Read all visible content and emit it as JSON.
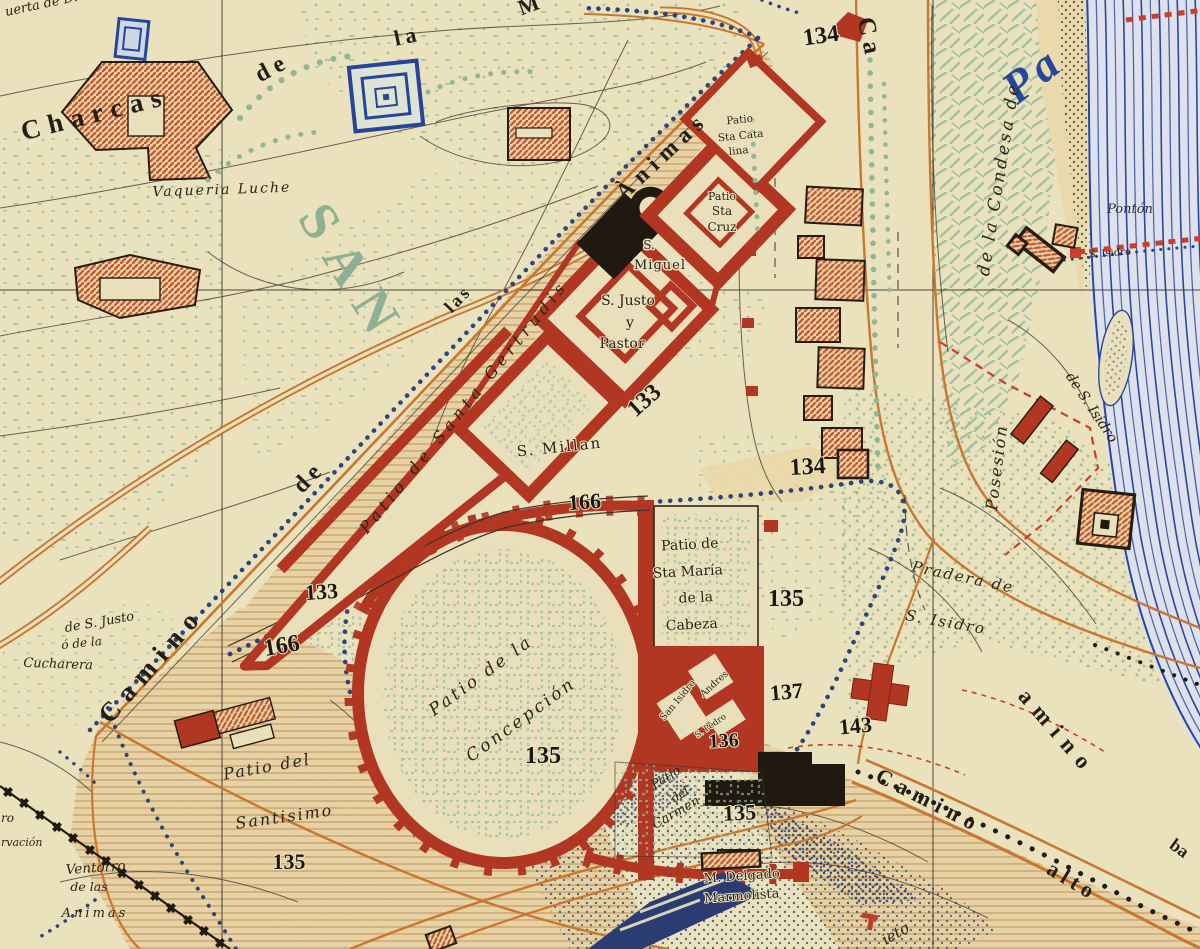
{
  "map": {
    "colors": {
      "paper": "#eae1bd",
      "wall_red": "#b23722",
      "road_orange": "#c9772f",
      "river_blue": "#2a479e",
      "dot_path_blue": "#1e3878",
      "rail_black": "#201a12",
      "stipple_green": "#9dbf9f",
      "park_green": "#9dbfa0",
      "tan_slope": "#e5d2a4",
      "dark_stipple": "#55617f",
      "building_hatch": "#bc5a31",
      "red_dash": "#c8402c"
    },
    "edge_fragments": {
      "huerta": "uerta de D.",
      "m_top": "M",
      "ro": "ro",
      "rvacion": "rvación",
      "ba": "ba",
      "ieto": "ieto",
      "pa": "Pa"
    },
    "roads": {
      "charcas": "Charcas",
      "de_top": "de",
      "la_top": "la",
      "camino_sw": "Camino",
      "de_mid": "de",
      "las": "las",
      "animas": "Ànimas",
      "ca_ne": "Ca",
      "amino_se": "amino",
      "camino_alto_1": "Camino",
      "camino_alto_2": "alto"
    },
    "areas": {
      "san": "SAN",
      "condesa": "de la Condesa de",
      "posesion": "Posesión",
      "pradera_1": "Pradera de",
      "pradera_2": "S. Isidro",
      "de_s_isidro": "de S. Isidro"
    },
    "sites": {
      "vaqueria": "Vaqueria Luche",
      "ventorro_1": "Ventorro",
      "ventorro_2": "de las",
      "ventorro_3": "Animas",
      "cucharera_1": "de S. Justo",
      "cucharera_2": "ó de la",
      "cucharera_3": "Cucharera",
      "ponton": "Pontón",
      "ponton_cross": "S. Isidro",
      "delgado_1": "M. Delgado",
      "delgado_2": "Marmolista"
    },
    "patios": {
      "gertrudis": "Patio de Santa Gertrudis",
      "millan": "S. Millan",
      "justo_1": "S. Justo",
      "justo_2": "y",
      "justo_3": "Pastor",
      "miguel_1": "S.",
      "miguel_2": "Miguel",
      "cruz_1": "Patio",
      "cruz_2": "Sta",
      "cruz_3": "Cruz",
      "catalina_1": "Patio",
      "catalina_2": "Sta Cata",
      "catalina_3": "lina",
      "maria_1": "Patio de",
      "maria_2": "Sta María",
      "maria_3": "de la",
      "maria_4": "Cabeza",
      "concepcion_1": "Patio de la",
      "concepcion_2": "Concepción",
      "santisimo_1": "Patio del",
      "santisimo_2": "Santisimo",
      "carmen_1": "Patio",
      "carmen_2": "del",
      "carmen_3": "Carmen",
      "san_isidro": "San Isidro",
      "andres": "Andres",
      "pedro": "S. Pedro"
    },
    "heights": {
      "h133_a": "133",
      "h133_b": "133",
      "h134_a": "134",
      "h134_b": "134",
      "h135_a": "135",
      "h135_b": "135",
      "h135_c": "135",
      "h135_d": "135",
      "h136": "136",
      "h137": "137",
      "h143": "143",
      "h166_a": "166",
      "h166_b": "166"
    }
  }
}
